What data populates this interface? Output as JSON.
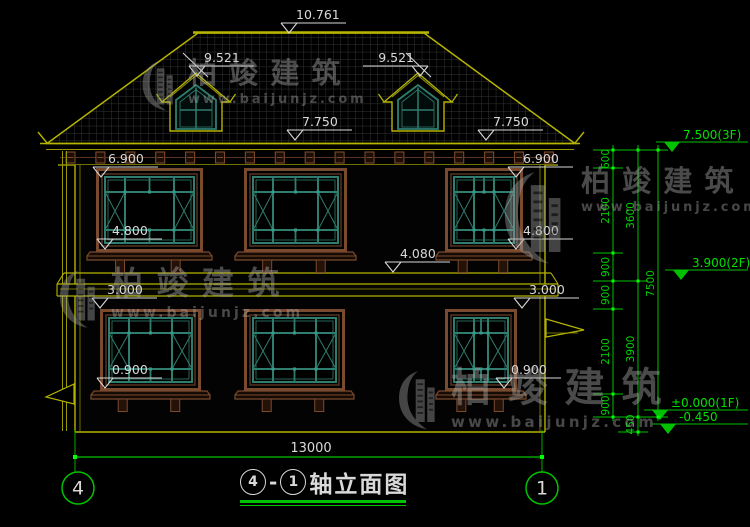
{
  "colors": {
    "background": "#000000",
    "structure_yellow": "#b5b400",
    "dim_green": "#00c200",
    "text_white": "#d9d9d9",
    "frame_brown": "#7a4a2e",
    "glass_teal": "#2f7d6e",
    "roof_hatch": "#343434"
  },
  "watermark": {
    "brand": "柏竣建筑",
    "url": "www.baijunjz.com"
  },
  "watermark_instances": [
    {
      "x": 140,
      "y": 58,
      "logo_h": 54,
      "title_size": 29,
      "url_size": 13
    },
    {
      "x": 57,
      "y": 267,
      "logo_h": 62,
      "title_size": 32,
      "url_size": 14
    },
    {
      "x": 500,
      "y": 166,
      "logo_h": 100,
      "title_size": 29,
      "url_size": 13
    },
    {
      "x": 396,
      "y": 367,
      "logo_h": 64,
      "title_size": 40,
      "url_size": 15
    }
  ],
  "elevation_markers": [
    {
      "label": "10.761",
      "x": 289,
      "y": 33
    },
    {
      "label": "9.521",
      "x": 197,
      "y": 76,
      "cross": true
    },
    {
      "label": "9.521",
      "x": 420,
      "y": 76,
      "cross": true,
      "align": "left"
    },
    {
      "label": "7.750",
      "x": 295,
      "y": 140
    },
    {
      "label": "7.750",
      "x": 486,
      "y": 140
    },
    {
      "label": "6.900",
      "x": 101,
      "y": 177
    },
    {
      "label": "6.900",
      "x": 516,
      "y": 177
    },
    {
      "label": "4.800",
      "x": 105,
      "y": 249
    },
    {
      "label": "4.800",
      "x": 516,
      "y": 249
    },
    {
      "label": "4.080",
      "x": 393,
      "y": 272
    },
    {
      "label": "3.000",
      "x": 100,
      "y": 308
    },
    {
      "label": "3.000",
      "x": 522,
      "y": 308
    },
    {
      "label": "0.900",
      "x": 105,
      "y": 388
    },
    {
      "label": "0.900",
      "x": 504,
      "y": 388
    }
  ],
  "right_markers": [
    {
      "label": "7.500(3F)",
      "x": 672,
      "y": 152
    },
    {
      "label": "3.900(2F)",
      "x": 681,
      "y": 280
    },
    {
      "label": "±0.000(1F)",
      "x": 660,
      "y": 420
    },
    {
      "label": "-0.450",
      "x": 668,
      "y": 434
    }
  ],
  "dim_chain": {
    "columns": [
      {
        "x": 613,
        "ticks": [
          150,
          168,
          253,
          281,
          309,
          394,
          417
        ],
        "labels": [
          "600",
          "2100",
          "900",
          "900",
          "2100",
          "900"
        ]
      },
      {
        "x": 638,
        "ticks": [
          150,
          281,
          417,
          432
        ],
        "labels": [
          "3600",
          "3900",
          "450"
        ]
      },
      {
        "x": 658,
        "ticks": [
          150,
          417
        ],
        "labels": [
          "7500"
        ]
      }
    ]
  },
  "bottom_dim": {
    "label": "13000",
    "x1": 75,
    "x2": 542,
    "y": 457,
    "text_x": 311,
    "text_y": 452
  },
  "axis_bubbles": [
    {
      "label": "4",
      "cx": 78,
      "cy": 488
    },
    {
      "label": "1",
      "cx": 542,
      "cy": 488
    }
  ],
  "title": {
    "axis_start": "4",
    "axis_end": "1",
    "dash": "-",
    "text": "轴立面图"
  },
  "windows": [
    {
      "x": 96,
      "y": 168,
      "w": 107,
      "h": 84
    },
    {
      "x": 244,
      "y": 168,
      "w": 103,
      "h": 84
    },
    {
      "x": 445,
      "y": 168,
      "w": 78,
      "h": 84
    },
    {
      "x": 100,
      "y": 309,
      "w": 101,
      "h": 82
    },
    {
      "x": 244,
      "y": 309,
      "w": 101,
      "h": 82
    },
    {
      "x": 445,
      "y": 309,
      "w": 72,
      "h": 82
    }
  ],
  "corbel_row": {
    "count": 17,
    "x_start": 66,
    "step": 29.9,
    "y": 152
  }
}
